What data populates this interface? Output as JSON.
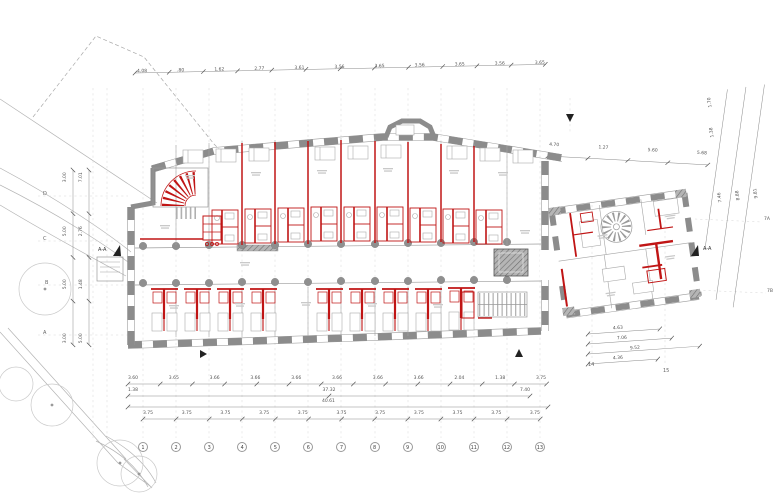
{
  "colors": {
    "highlight_red": "#c01515",
    "wall_gray": "#8c8c8c"
  },
  "grid": {
    "columns": [
      "1",
      "2",
      "3",
      "4",
      "5",
      "6",
      "7",
      "8",
      "9",
      "10",
      "11",
      "12",
      "13"
    ],
    "wing_columns": [
      "14",
      "15"
    ],
    "rows": [
      "D",
      "C",
      "B",
      "A"
    ],
    "wing_rows": [
      "7A",
      "7B"
    ]
  },
  "sections": {
    "aa_left": "A-A",
    "aa_right": "A-A"
  },
  "dimensions": {
    "top": [
      "4.08",
      ".80",
      "1.62",
      "2.77",
      "3.61",
      "3.56",
      "3.65",
      "3.56",
      "3.65",
      "3.56",
      "3.65"
    ],
    "top_right": [
      "4.70",
      "1.27",
      "5.60",
      "5.68"
    ],
    "bottom_row1": [
      "3.60",
      "3.65",
      "3.66",
      "3.66",
      "3.66",
      "3.66",
      "3.66",
      "3.66",
      "2.04",
      "1.38",
      "3.75"
    ],
    "bottom_row2": [
      "1.38",
      "37.32",
      "7.40"
    ],
    "bottom_row3_total": "40.61",
    "bottom_row4": [
      "3.75",
      "3.75",
      "3.75",
      "3.75",
      "3.75",
      "3.75",
      "3.75",
      "3.75",
      "3.75",
      "3.75",
      "3.75"
    ],
    "left_outer": [
      "3.00",
      "5.00",
      "5.00",
      "3.00"
    ],
    "left_inner": [
      "7.01",
      "2.76",
      "1.48",
      "5.00"
    ],
    "right_slanted": [
      "7.46",
      "8.88",
      "9.81"
    ],
    "right_slanted_segments": [
      "1.70",
      "1.38"
    ],
    "wing_bottom": [
      "4.63",
      "7.06",
      "9.52",
      "4.36"
    ]
  }
}
